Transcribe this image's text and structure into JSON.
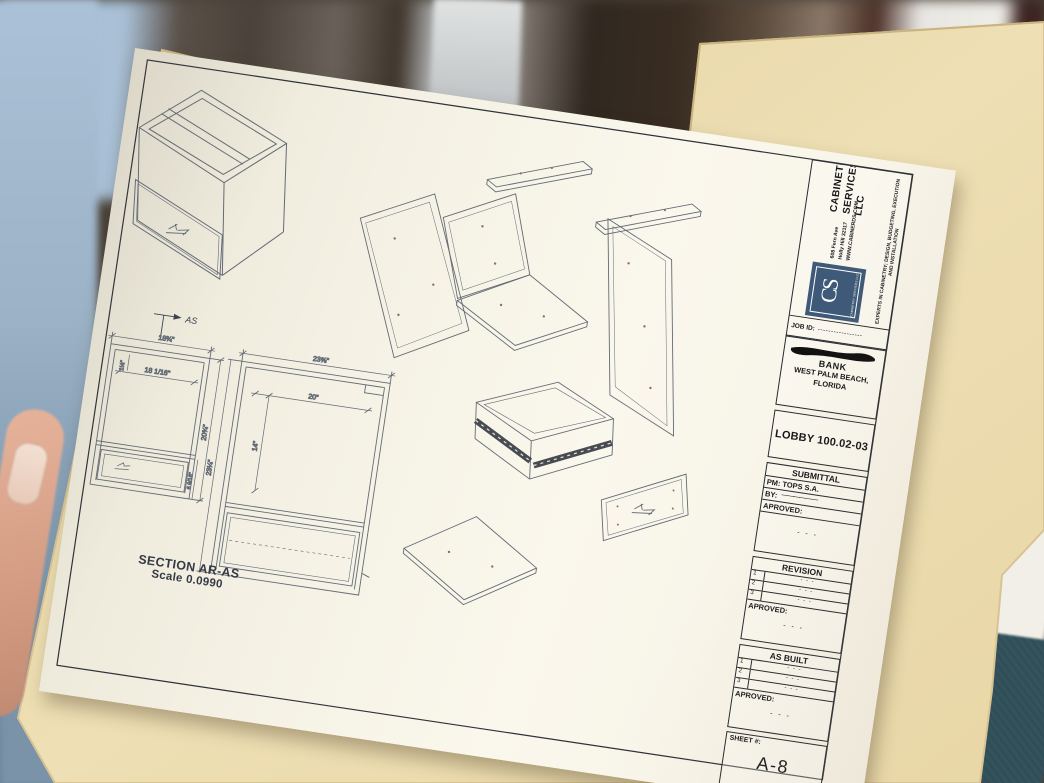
{
  "colors": {
    "paper": "#f8f4e9",
    "folder": "#ecdbad",
    "logo_blue": "#3e5a78",
    "fabric_teal": "#2e4c56",
    "background_blue": "#a9c0d6",
    "thumb_skin": "#dfa98f",
    "drawing_line_gray": "#646b76"
  },
  "title_block": {
    "company": {
      "name_lines": [
        "CABINETRY",
        "SERVICES",
        "LLC"
      ],
      "address_lines": [
        "608 Fern Ave",
        "Holly Hill 32117",
        "WWW.CABINERDS.COM"
      ],
      "tagline": "EXPERTS IN CABINETRY; DESIGN, BUDGETING, EXECUTION AND INSTALLATION",
      "logo_monogram": "CS",
      "logo_subtext": "CABINETRY SERVICES LLC"
    },
    "job_id": {
      "label": "JOB ID:",
      "value": "-----------------"
    },
    "project": {
      "client": "BANK",
      "city": "WEST PALM BEACH,",
      "state": "FLORIDA"
    },
    "location_code": "LOBBY 100.02-03",
    "submittal": {
      "header": "SUBMITTAL",
      "pm_row": "PM: TOPS S.A.",
      "by_label": "BY:",
      "by_value": "——————",
      "approved_label": "APROVED:",
      "approved_dots": "- - -"
    },
    "revision": {
      "header": "REVISION",
      "rows": [
        {
          "num": "1",
          "value": "- - -"
        },
        {
          "num": "2",
          "value": "- - -"
        },
        {
          "num": "3",
          "value": "- - -"
        }
      ],
      "approved_label": "APROVED:",
      "approved_dots": "- - -"
    },
    "as_built": {
      "header": "AS BUILT",
      "rows": [
        {
          "num": "1",
          "value": "- - -"
        },
        {
          "num": "2",
          "value": "- - -"
        },
        {
          "num": "3",
          "value": "- - -"
        }
      ],
      "approved_label": "APROVED:",
      "approved_dots": "- - -"
    },
    "sheet": {
      "label": "SHEET #:",
      "number": "A-8"
    }
  },
  "drawing": {
    "caption": {
      "line1": "SECTION AR-AS",
      "line2": "Scale 0.0990"
    },
    "section_marker": "AS",
    "left_view_dims": {
      "overall_width": "18¾\"",
      "inner_width": "18 1/16\"",
      "top_reveal": "1½\"",
      "overall_height": "20¾\"",
      "drawer_height": "6 9/16\""
    },
    "right_view_dims": {
      "overall_width": "23⅝\"",
      "inner_width": "20\"",
      "inner_height": "14\"",
      "overall_height": "23¼\""
    }
  }
}
